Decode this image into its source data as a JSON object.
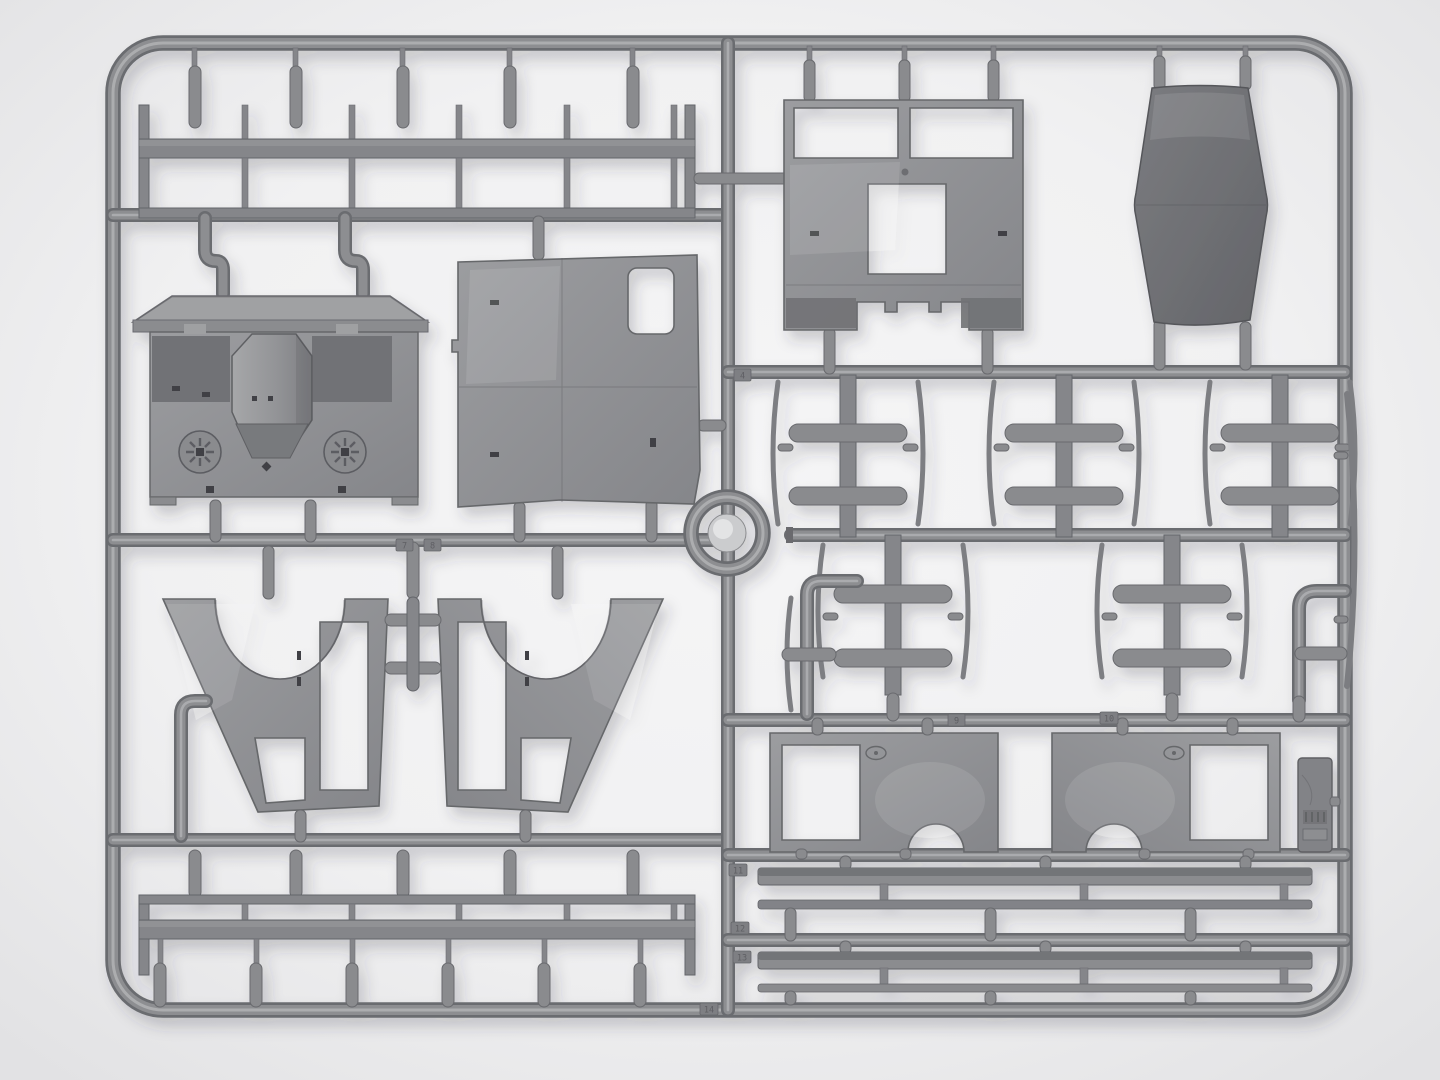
{
  "scene": {
    "type": "photograph",
    "subject": "Grey injection-moulded plastic model-kit sprue (runner frame) holding truck cab parts, shot top-down on a white seamless background",
    "background_color": "#f1f1f2",
    "plastic_color": "#8d8e91",
    "plastic_dark": "#6b6c70",
    "plastic_highlight": "#b2b3b5",
    "dark_part_color": "#717276",
    "shadow_color": "#3a3a40"
  },
  "tags": [
    {
      "label": "4"
    },
    {
      "label": "7"
    },
    {
      "label": "8"
    },
    {
      "label": "9"
    },
    {
      "label": "10"
    },
    {
      "label": "11"
    },
    {
      "label": "12"
    },
    {
      "label": "13"
    },
    {
      "label": "14"
    }
  ],
  "parts": [
    {
      "name": "cargo-rack-rail-top"
    },
    {
      "name": "cab-cowl-with-hood"
    },
    {
      "name": "cab-door-panel"
    },
    {
      "name": "cab-rear-panel"
    },
    {
      "name": "cab-roof-panel"
    },
    {
      "name": "crossmember-set-upper-row"
    },
    {
      "name": "crossmember-set-lower-row"
    },
    {
      "name": "exhaust-elbow-pipe-left"
    },
    {
      "name": "exhaust-elbow-pipe-right"
    },
    {
      "name": "curved-spring-blades"
    },
    {
      "name": "wheel-arch-fender-left"
    },
    {
      "name": "wheel-arch-fender-right"
    },
    {
      "name": "cab-floor-panel-left"
    },
    {
      "name": "cab-floor-panel-right"
    },
    {
      "name": "data-plate"
    },
    {
      "name": "running-board-strips"
    },
    {
      "name": "cargo-rack-rail-bottom"
    },
    {
      "name": "sprue-gate-ring"
    }
  ]
}
